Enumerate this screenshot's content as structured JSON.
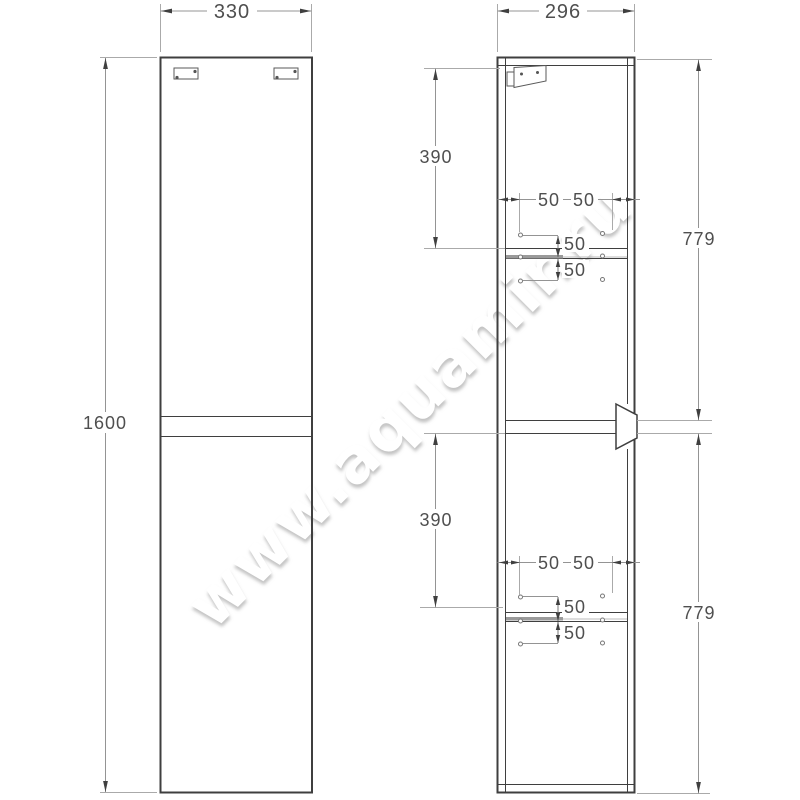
{
  "watermark": {
    "text": "www.aquamir.ru"
  },
  "views": {
    "front": {
      "label": "front-view"
    },
    "side": {
      "label": "side-view"
    }
  },
  "dimensions": {
    "front_width": "330",
    "front_height": "1600",
    "side_depth": "296",
    "upper_section_height": "390",
    "lower_section_height": "390",
    "upper_door_height": "779",
    "lower_door_height": "779",
    "upper_hole_inset_front": "50",
    "upper_hole_inset_back": "50",
    "upper_hole_pitch_above": "50",
    "upper_hole_pitch_below": "50",
    "lower_hole_inset_front": "50",
    "lower_hole_inset_back": "50",
    "lower_hole_pitch_above": "50",
    "lower_hole_pitch_below": "50"
  },
  "colors": {
    "outline": "#3f3f3f",
    "dimension_line": "#949494",
    "dimension_text": "#4f4f4f",
    "shelf_fill": "#9a9a9a"
  }
}
